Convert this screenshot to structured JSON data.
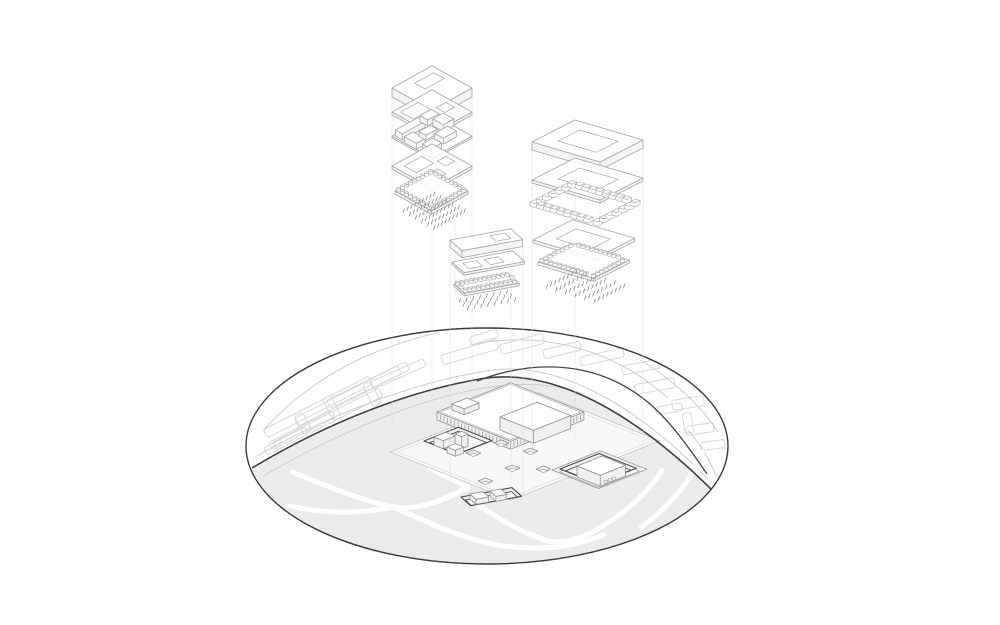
{
  "meta": {
    "title": "Exploded axonometric architectural site diagram",
    "canvas": {
      "w": 1000,
      "h": 625
    }
  },
  "colors": {
    "background": "#ffffff",
    "ellipse_border": "#3a3a3a",
    "road_dark": "#424242",
    "road_light": "#cccccc",
    "park_fill": "#ebebeb",
    "plaza_fill": "#f8f8f8",
    "path_white": "#ffffff",
    "context_stroke": "#d7d7d7",
    "stack_line": "#a5a5a5",
    "stack_face": "#f4f4f4",
    "site_line": "#8e8e8e",
    "site_dark": "#4a4a4a",
    "pit_floor": "#f0f0f0",
    "tick": "#8a8a8a",
    "guide": "#dcdcdc"
  },
  "ellipse": {
    "cx": 487,
    "cy": 446,
    "rx": 241,
    "ry": 118
  },
  "bases": {
    "iso": {
      "e1": [
        0.87,
        -0.48
      ],
      "e2": [
        0.87,
        0.48
      ]
    },
    "rstack": {
      "e1": [
        0.896,
        -0.458
      ],
      "e2": [
        0.958,
        0.282
      ]
    },
    "bar": {
      "e1": [
        0.98,
        -0.18
      ],
      "e2": [
        0.74,
        0.67
      ]
    },
    "site": {
      "e1": [
        0.93,
        -0.37
      ],
      "e2": [
        0.93,
        0.37
      ]
    }
  },
  "roads": {
    "main_dark": "M252,468 C330,421 410,391 480,379 C560,365 646,424 714,492",
    "branch_dark": "M477,381 C540,357 602,363 650,404 C672,423 692,452 707,474",
    "light_edges": [
      "M257,456 C338,410 418,382 486,371 C562,358 644,413 708,479",
      "M263,476 C340,432 414,400 484,388 C520,382 552,383 584,394",
      "M470,345 C540,330 612,348 668,398",
      "M688,430 C700,444 710,460 716,476",
      "M263,431 C292,398 336,365 390,347 C406,341 422,336 438,333",
      "M640,360 C670,378 700,404 718,432"
    ]
  },
  "park": {
    "fill": "M252,468 C330,421 410,391 480,379 C560,365 646,424 714,492 L760,560 L745,625 L230,625 L210,520 Z",
    "paths": [
      "M292,472 C345,494 375,504 394,507 C420,511 446,499 468,487",
      "M394,507 C424,521 456,536 492,544 C534,552 572,548 603,535",
      "M290,506 C325,514 358,514 394,507",
      "M468,498 C498,519 521,532 547,541",
      "M662,470 C648,494 622,515 596,530 C577,541 561,543 547,541",
      "M702,452 C693,478 672,505 641,527",
      "M430,468 C446,477 458,482 468,487"
    ]
  },
  "context_buildings": [
    {
      "cx": 318,
      "cy": 407,
      "w": 118,
      "h": 9,
      "angle": -27
    },
    {
      "cx": 328,
      "cy": 419,
      "w": 118,
      "h": 9,
      "angle": -27
    },
    {
      "cx": 348,
      "cy": 396,
      "w": 116,
      "h": 9,
      "angle": -27
    },
    {
      "cx": 302,
      "cy": 430,
      "w": 70,
      "h": 8,
      "angle": -27
    },
    {
      "cx": 368,
      "cy": 385,
      "w": 88,
      "h": 9,
      "angle": -26
    },
    {
      "cx": 286,
      "cy": 441,
      "w": 46,
      "h": 8,
      "angle": -27
    },
    {
      "cx": 398,
      "cy": 374,
      "w": 58,
      "h": 8,
      "angle": -24
    },
    {
      "cx": 332,
      "cy": 408,
      "w": 9,
      "h": 24,
      "angle": -27
    },
    {
      "cx": 372,
      "cy": 394,
      "w": 9,
      "h": 24,
      "angle": -27
    },
    {
      "cx": 303,
      "cy": 423,
      "w": 9,
      "h": 20,
      "angle": -27
    },
    {
      "cx": 470,
      "cy": 352,
      "w": 58,
      "h": 10,
      "angle": -16
    },
    {
      "cx": 522,
      "cy": 344,
      "w": 44,
      "h": 10,
      "angle": -15
    },
    {
      "cx": 562,
      "cy": 350,
      "w": 38,
      "h": 9,
      "angle": -14
    },
    {
      "cx": 602,
      "cy": 357,
      "w": 44,
      "h": 9,
      "angle": -12
    },
    {
      "cx": 641,
      "cy": 367,
      "w": 38,
      "h": 9,
      "angle": -11
    },
    {
      "cx": 484,
      "cy": 337,
      "w": 28,
      "h": 8,
      "angle": -17
    },
    {
      "cx": 655,
      "cy": 386,
      "w": 40,
      "h": 10,
      "angle": -10
    },
    {
      "cx": 688,
      "cy": 403,
      "w": 32,
      "h": 10,
      "angle": -9
    },
    {
      "cx": 669,
      "cy": 409,
      "w": 26,
      "h": 8,
      "angle": -10
    },
    {
      "cx": 700,
      "cy": 429,
      "w": 28,
      "h": 9,
      "angle": -8
    },
    {
      "cx": 713,
      "cy": 445,
      "w": 24,
      "h": 8,
      "angle": -8
    },
    {
      "cx": 688,
      "cy": 423,
      "w": 9,
      "h": 20,
      "angle": -8
    },
    {
      "cx": 707,
      "cy": 388,
      "w": 16,
      "h": 8,
      "angle": -9
    }
  ],
  "stacks": [
    {
      "name": "floor-stack-left",
      "basis": "iso",
      "layers": [
        {
          "type": "slab",
          "p": [
            392,
            88
          ],
          "a": 46,
          "b": 46,
          "t": 9,
          "holes": [
            [
              18,
              8,
              22,
              12
            ]
          ]
        },
        {
          "type": "plate",
          "p": [
            392,
            112
          ],
          "a": 46,
          "b": 46,
          "t": 3,
          "holes": [
            [
              5,
              5,
              20,
              15
            ],
            [
              30,
              21,
              11,
              10
            ],
            [
              10,
              27,
              11,
              11
            ]
          ]
        },
        {
          "type": "walls",
          "p": [
            392,
            136
          ],
          "a": 46,
          "b": 46,
          "boxes": [
            [
              2,
              2,
              26,
              8,
              6
            ],
            [
              31,
              1,
              13,
              9,
              6
            ],
            [
              0,
              14,
              10,
              14,
              6
            ],
            [
              34,
              13,
              12,
              12,
              7
            ],
            [
              15,
              16,
              13,
              8,
              5
            ],
            [
              21,
              28,
              15,
              10,
              6
            ],
            [
              3,
              32,
              12,
              10,
              6
            ]
          ]
        },
        {
          "type": "plate",
          "p": [
            392,
            166
          ],
          "a": 46,
          "b": 46,
          "t": 3,
          "holes": [
            [
              7,
              7,
              20,
              14
            ],
            [
              31,
              21,
              10,
              10
            ],
            [
              13,
              29,
              10,
              10
            ]
          ]
        },
        {
          "type": "tray",
          "p": [
            395,
            191
          ],
          "a": 42,
          "b": 42,
          "t": 3
        },
        {
          "type": "ticks",
          "p": [
            403,
            213
          ],
          "a": 35,
          "b": 35,
          "cols": 9,
          "rows": 6
        }
      ]
    },
    {
      "name": "floor-stack-middle",
      "basis": "bar",
      "layers": [
        {
          "type": "slab",
          "p": [
            450,
            240
          ],
          "a": 62,
          "b": 16,
          "t": 7,
          "holes": [
            [
              38,
              4,
              15,
              8
            ]
          ]
        },
        {
          "type": "plate",
          "p": [
            452,
            262
          ],
          "a": 62,
          "b": 16,
          "t": 2.5,
          "holes": [
            [
              8,
              4,
              14,
              8
            ],
            [
              30,
              4,
              14,
              8
            ]
          ]
        },
        {
          "type": "tray",
          "p": [
            454,
            284
          ],
          "a": 56,
          "b": 14,
          "t": 2.5
        },
        {
          "type": "ticks",
          "p": [
            459,
            303
          ],
          "a": 48,
          "b": 11,
          "cols": 8,
          "rows": 3
        }
      ]
    },
    {
      "name": "floor-stack-right",
      "basis": "rstack",
      "layers": [
        {
          "type": "slab",
          "p": [
            532,
            142
          ],
          "a": 48,
          "b": 71,
          "t": 8,
          "holes": [
            [
              12,
              16,
              24,
              40
            ]
          ]
        },
        {
          "type": "plate",
          "p": [
            532,
            180
          ],
          "a": 48,
          "b": 71,
          "t": 3,
          "holes": [
            [
              12,
              16,
              24,
              40
            ]
          ]
        },
        {
          "type": "ring",
          "p": [
            530,
            206
          ],
          "a": 48,
          "b": 71,
          "s": 5,
          "h": 4,
          "step": 7
        },
        {
          "type": "plate",
          "p": [
            533,
            240
          ],
          "a": 44,
          "b": 65,
          "t": 3,
          "holes": [
            [
              11,
              14,
              22,
              36
            ]
          ]
        },
        {
          "type": "tray",
          "p": [
            538,
            262
          ],
          "a": 40,
          "b": 58,
          "t": 3
        },
        {
          "type": "ticks",
          "p": [
            546,
            289
          ],
          "a": 33,
          "b": 50,
          "cols": 8,
          "rows": 6
        }
      ]
    }
  ],
  "site": {
    "plaza": {
      "basis": "site",
      "p": [
        390,
        452
      ],
      "a": 160,
      "b": 130
    },
    "elements": [
      {
        "type": "pit",
        "name": "right-courtyard-outer",
        "basis": "site",
        "p": [
          552,
          470
        ],
        "a": 52,
        "b": 50,
        "ins": 4,
        "dark": false
      },
      {
        "type": "pit",
        "name": "right-courtyard",
        "basis": "site",
        "p": [
          560,
          469
        ],
        "a": 42,
        "b": 40,
        "ins": 3,
        "dark": true
      },
      {
        "type": "prism",
        "name": "right-pavilion",
        "basis": "site",
        "p": [
          577,
          466
        ],
        "a": 27,
        "b": 25,
        "t": 11,
        "win": 3
      },
      {
        "type": "prism",
        "name": "podium",
        "basis": "site",
        "p": [
          437,
          412
        ],
        "a": 79,
        "b": 79,
        "t": 8,
        "colonnade": true
      },
      {
        "type": "prism",
        "name": "main-hall",
        "basis": "site",
        "p": [
          500,
          417
        ],
        "a": 40,
        "b": 36,
        "t": 13
      },
      {
        "type": "prism",
        "name": "entrance-box",
        "basis": "site",
        "p": [
          452,
          404
        ],
        "a": 16,
        "b": 13,
        "t": 6
      },
      {
        "type": "pit",
        "name": "left-courtyard",
        "basis": "site",
        "p": [
          424,
          441
        ],
        "a": 37,
        "b": 36,
        "ins": 3,
        "dark": true
      },
      {
        "type": "prism",
        "name": "court-box-1",
        "basis": "site",
        "p": [
          434,
          437
        ],
        "a": 13,
        "b": 10,
        "t": 8
      },
      {
        "type": "prism",
        "name": "court-box-2",
        "basis": "site",
        "p": [
          455,
          434
        ],
        "a": 7,
        "b": 7,
        "t": 12
      },
      {
        "type": "prism",
        "name": "court-box-3",
        "basis": "site",
        "p": [
          447,
          447
        ],
        "a": 9,
        "b": 9,
        "t": 6
      },
      {
        "type": "pit",
        "name": "bottom-courtyard",
        "basis": "bar",
        "p": [
          461,
          497
        ],
        "a": 52,
        "b": 13,
        "ins": 2.5,
        "dark": true
      },
      {
        "type": "prism",
        "name": "bar-box-1",
        "basis": "bar",
        "p": [
          470,
          494
        ],
        "a": 13,
        "b": 8,
        "t": 5
      },
      {
        "type": "prism",
        "name": "bar-box-2",
        "basis": "bar",
        "p": [
          490,
          491
        ],
        "a": 11,
        "b": 8,
        "t": 5
      },
      {
        "type": "pit",
        "name": "skylight-1",
        "basis": "site",
        "p": [
          466,
          453
        ],
        "a": 8,
        "b": 8,
        "ins": 1.5,
        "dark": false
      },
      {
        "type": "pit",
        "name": "skylight-2",
        "basis": "site",
        "p": [
          494,
          443
        ],
        "a": 8,
        "b": 8,
        "ins": 1.5,
        "dark": false
      },
      {
        "type": "pit",
        "name": "skylight-3",
        "basis": "site",
        "p": [
          523,
          451
        ],
        "a": 8,
        "b": 8,
        "ins": 1.5,
        "dark": false
      },
      {
        "type": "pit",
        "name": "skylight-4",
        "basis": "site",
        "p": [
          505,
          468
        ],
        "a": 8,
        "b": 8,
        "ins": 1.5,
        "dark": false
      },
      {
        "type": "pit",
        "name": "skylight-5",
        "basis": "site",
        "p": [
          536,
          469
        ],
        "a": 8,
        "b": 8,
        "ins": 1.5,
        "dark": false
      },
      {
        "type": "pit",
        "name": "skylight-6",
        "basis": "site",
        "p": [
          478,
          481
        ],
        "a": 8,
        "b": 8,
        "ins": 1.5,
        "dark": false
      }
    ]
  },
  "guides": [
    {
      "x": 392,
      "y1": 96,
      "y2": 428
    },
    {
      "x": 432,
      "y1": 72,
      "y2": 402
    },
    {
      "x": 472,
      "y1": 94,
      "y2": 420
    },
    {
      "x": 450,
      "y1": 244,
      "y2": 492
    },
    {
      "x": 511,
      "y1": 233,
      "y2": 486
    },
    {
      "x": 523,
      "y1": 246,
      "y2": 497
    },
    {
      "x": 532,
      "y1": 148,
      "y2": 452
    },
    {
      "x": 575,
      "y1": 124,
      "y2": 440
    },
    {
      "x": 643,
      "y1": 144,
      "y2": 455
    },
    {
      "x": 455,
      "y1": 112,
      "y2": 296
    },
    {
      "x": 600,
      "y1": 160,
      "y2": 300
    }
  ]
}
